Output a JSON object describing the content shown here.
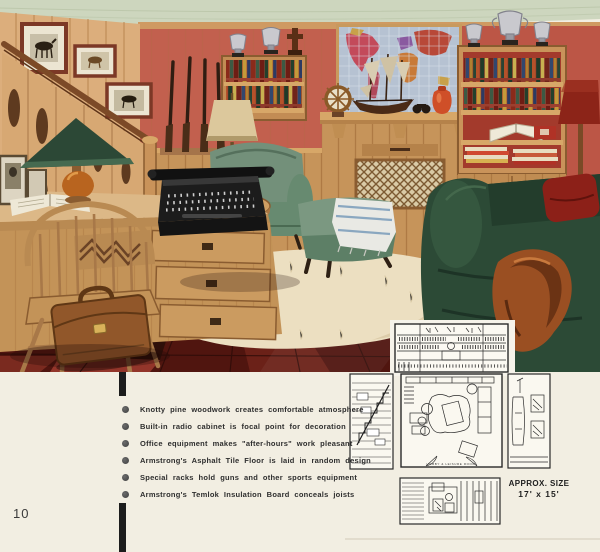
{
  "page": {
    "number": "10"
  },
  "colors": {
    "page_bg": "#f2eee2",
    "accent_bar": "#1c1c1c",
    "ceiling_green": "#cdd6be",
    "wall_salmon": "#c2604e",
    "pine_wood": "#d0a066",
    "floor_dark": "#50150f",
    "floor_red": "#8d3427",
    "chair_green": "#73907a",
    "sofa_green": "#2c4a36",
    "rug_cream": "#ecdfc1"
  },
  "bullets": {
    "items": [
      "Knotty pine woodwork creates comfortable atmosphere",
      "Built-in radio cabinet is focal point for decoration",
      "Office equipment makes \"after-hours\" work pleasant",
      "Armstrong's Asphalt Tile Floor is laid in random design",
      "Special racks hold guns and other sports equipment",
      "Armstrong's Temlok Insulation Board conceals joists"
    ]
  },
  "plans": {
    "approx_size_label": "APPROX. SIZE",
    "dimensions": "17' x 15'",
    "floor_plan_caption": "HOBBY  &  LEISURE  ROOM"
  },
  "illustration": {
    "alt": "Knotty pine den with staircase, framed horse prints, gun rack with rifles, world map over built-in radio cabinet, trophy-topped bookshelves, desk with typewriter and green-shaded lamp, Windsor chair, leather briefcase, green lounge chair with ottoman, dark green sofa with red cushion and leather jacket, white fur rug on dark red random-design asphalt tile floor"
  }
}
